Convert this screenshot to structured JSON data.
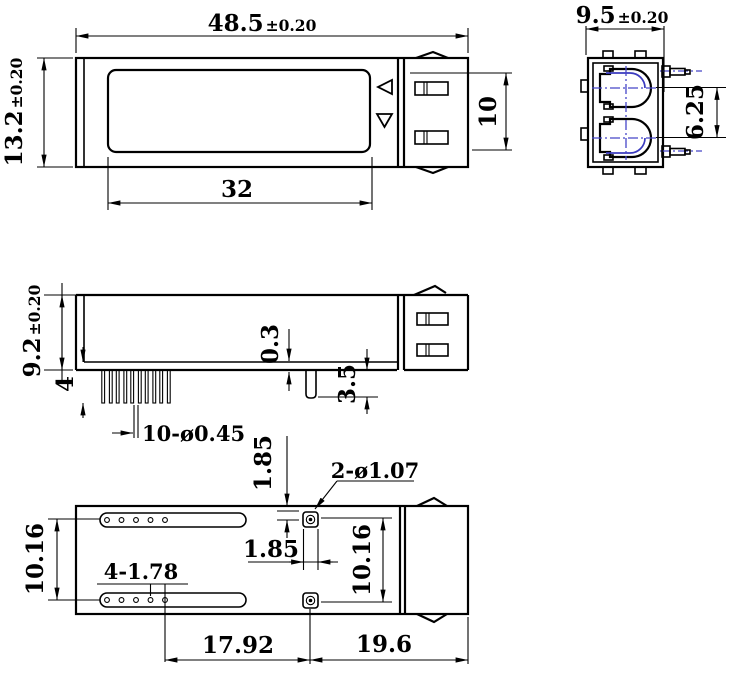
{
  "drawing": {
    "type": "mechanical-dimension-drawing",
    "views": [
      "top-view",
      "end-view",
      "side-view",
      "bottom-view"
    ],
    "colors": {
      "line": "#000000",
      "centerline": "#4646c8",
      "background": "#ffffff"
    }
  },
  "dims": {
    "top_width": {
      "value": "48.5",
      "tol": "±0.20"
    },
    "top_height": {
      "value": "13.2",
      "tol": "±0.20"
    },
    "top_label_width": "32",
    "top_connector": "10",
    "end_width": {
      "value": "9.5",
      "tol": "±0.20"
    },
    "end_port_pitch": "6.25",
    "side_height": {
      "value": "9.2",
      "tol": "±0.20"
    },
    "side_pin_length": "4",
    "side_pins_note": "10-ø0.45",
    "side_standoff": "0.3",
    "side_post": "3.5",
    "bot_slot_pitch": "10.16",
    "bot_holes_note": "4-1.78",
    "bot_pad_v": "1.85",
    "bot_pad_h": "1.85",
    "bot_pads_note": "2-ø1.07",
    "bot_pad_pitch": "10.16",
    "bot_pad_x": "17.92",
    "bot_conn_len": "19.6"
  }
}
